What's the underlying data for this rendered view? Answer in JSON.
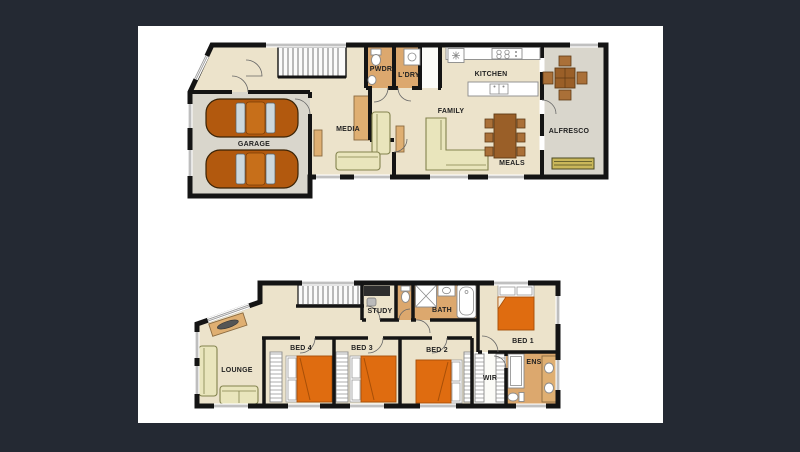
{
  "colors": {
    "background": "#242933",
    "paper": "#ffffff",
    "wall": "#141414",
    "floor_cream": "#ece3cb",
    "floor_tan": "#dca86e",
    "floor_grey": "#d9d6cc",
    "bed_orange": "#df6c10",
    "sofa_cream": "#e9e5bc",
    "timber_brown": "#9a5f28",
    "car_copper": "#b2590e",
    "label_text": "#222222"
  },
  "ground_floor": {
    "labels": {
      "garage": "GARAGE",
      "media": "MEDIA",
      "family": "FAMILY",
      "kitchen": "KITCHEN",
      "meals": "MEALS",
      "alfresco": "ALFRESCO",
      "powder": "PWDR",
      "laundry": "L'DRY"
    }
  },
  "first_floor": {
    "labels": {
      "lounge": "LOUNGE",
      "bed4": "BED 4",
      "bed3": "BED 3",
      "bed2": "BED 2",
      "bed1": "BED 1",
      "study": "STUDY",
      "bath": "BATH",
      "wir": "WIR",
      "ens": "ENS"
    }
  }
}
